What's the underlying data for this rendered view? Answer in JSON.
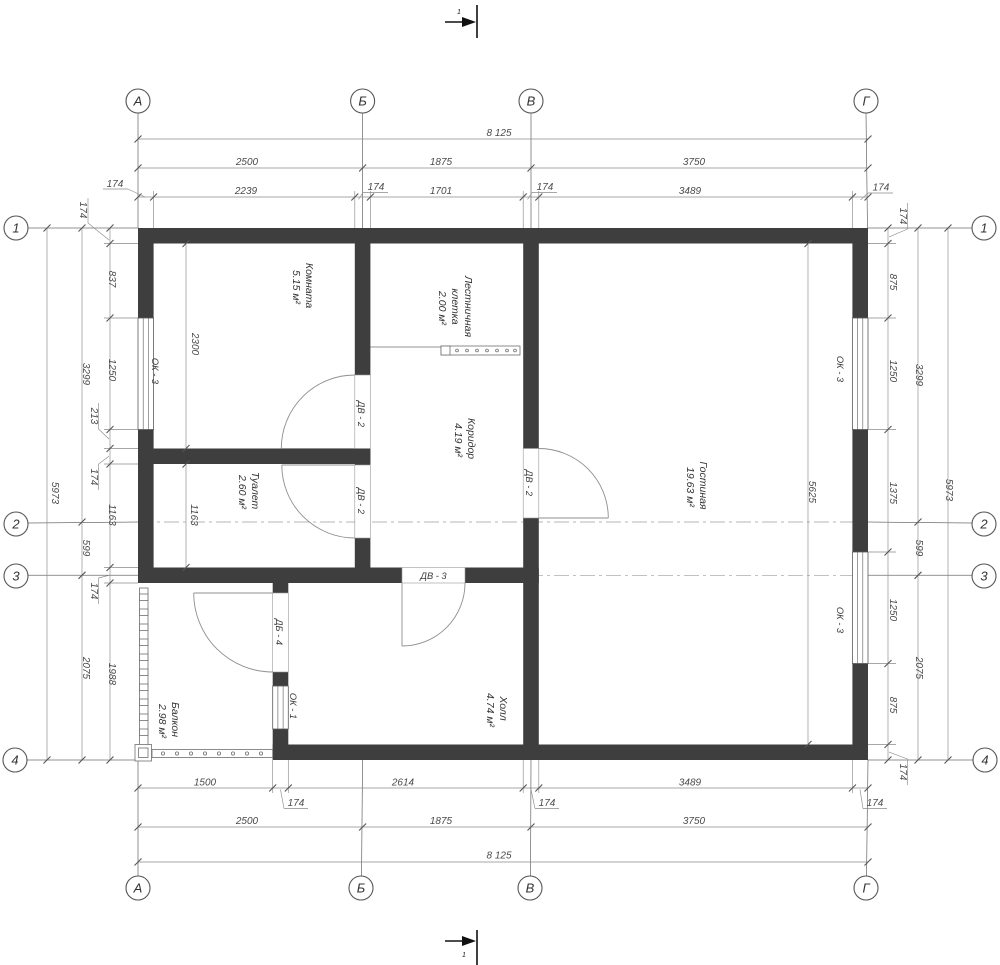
{
  "axes": {
    "top": [
      "А",
      "Б",
      "В",
      "Г"
    ],
    "bottom": [
      "А",
      "Б",
      "В",
      "Г"
    ],
    "left": [
      "1",
      "2",
      "3",
      "4"
    ],
    "right": [
      "1",
      "2",
      "3",
      "4"
    ]
  },
  "section": {
    "top": "1",
    "bottom": "1"
  },
  "rooms": {
    "komnata": {
      "name": "Комната",
      "area": "5.15 м²"
    },
    "stair": {
      "name": "Лестничная",
      "name2": "клетка",
      "area": "2.00 м²"
    },
    "corridor": {
      "name": "Коридор",
      "area": "4.19 м²"
    },
    "living": {
      "name": "Гостиная",
      "area": "19.63 м²"
    },
    "wc": {
      "name": "Туалет",
      "area": "2.60 м²"
    },
    "hall": {
      "name": "Холл",
      "area": "4.74 м²"
    },
    "balcony": {
      "name": "Балкон",
      "area": "2.98 м²"
    }
  },
  "openings": {
    "window_left": "ОК - 3",
    "window_right_top": "ОК - 3",
    "window_right_bottom": "ОК - 3",
    "window_balcony": "ОК - 1",
    "door_room": "ДВ - 2",
    "door_wc": "ДВ - 2",
    "door_living": "ДВ - 2",
    "door_hall": "ДВ - 3",
    "door_balcony": "ДБ - 4"
  },
  "dimensions": {
    "top": {
      "row1": [
        "174",
        "2239",
        "174",
        "1701",
        "174",
        "3489",
        "174"
      ],
      "row2": [
        "2500",
        "1875",
        "3750"
      ],
      "total": "8 125"
    },
    "bottom": {
      "row1": [
        "1500",
        "174",
        "2614",
        "174",
        "3489",
        "174"
      ],
      "row2": [
        "2500",
        "1875",
        "3750"
      ],
      "total": "8 125"
    },
    "left": {
      "chain": [
        "174",
        "837",
        "1250",
        "213",
        "174",
        "1163",
        "174",
        "1988"
      ],
      "axis": [
        "3299",
        "599",
        "2075"
      ],
      "total": "5973"
    },
    "right": {
      "chain": [
        "174",
        "875",
        "1250",
        "1375",
        "1250",
        "875",
        "174"
      ],
      "axis": [
        "3299",
        "599",
        "2075"
      ],
      "total": "5973"
    },
    "interior": {
      "room_width": "2300",
      "wc_height": "1163",
      "living_height": "5625"
    }
  }
}
